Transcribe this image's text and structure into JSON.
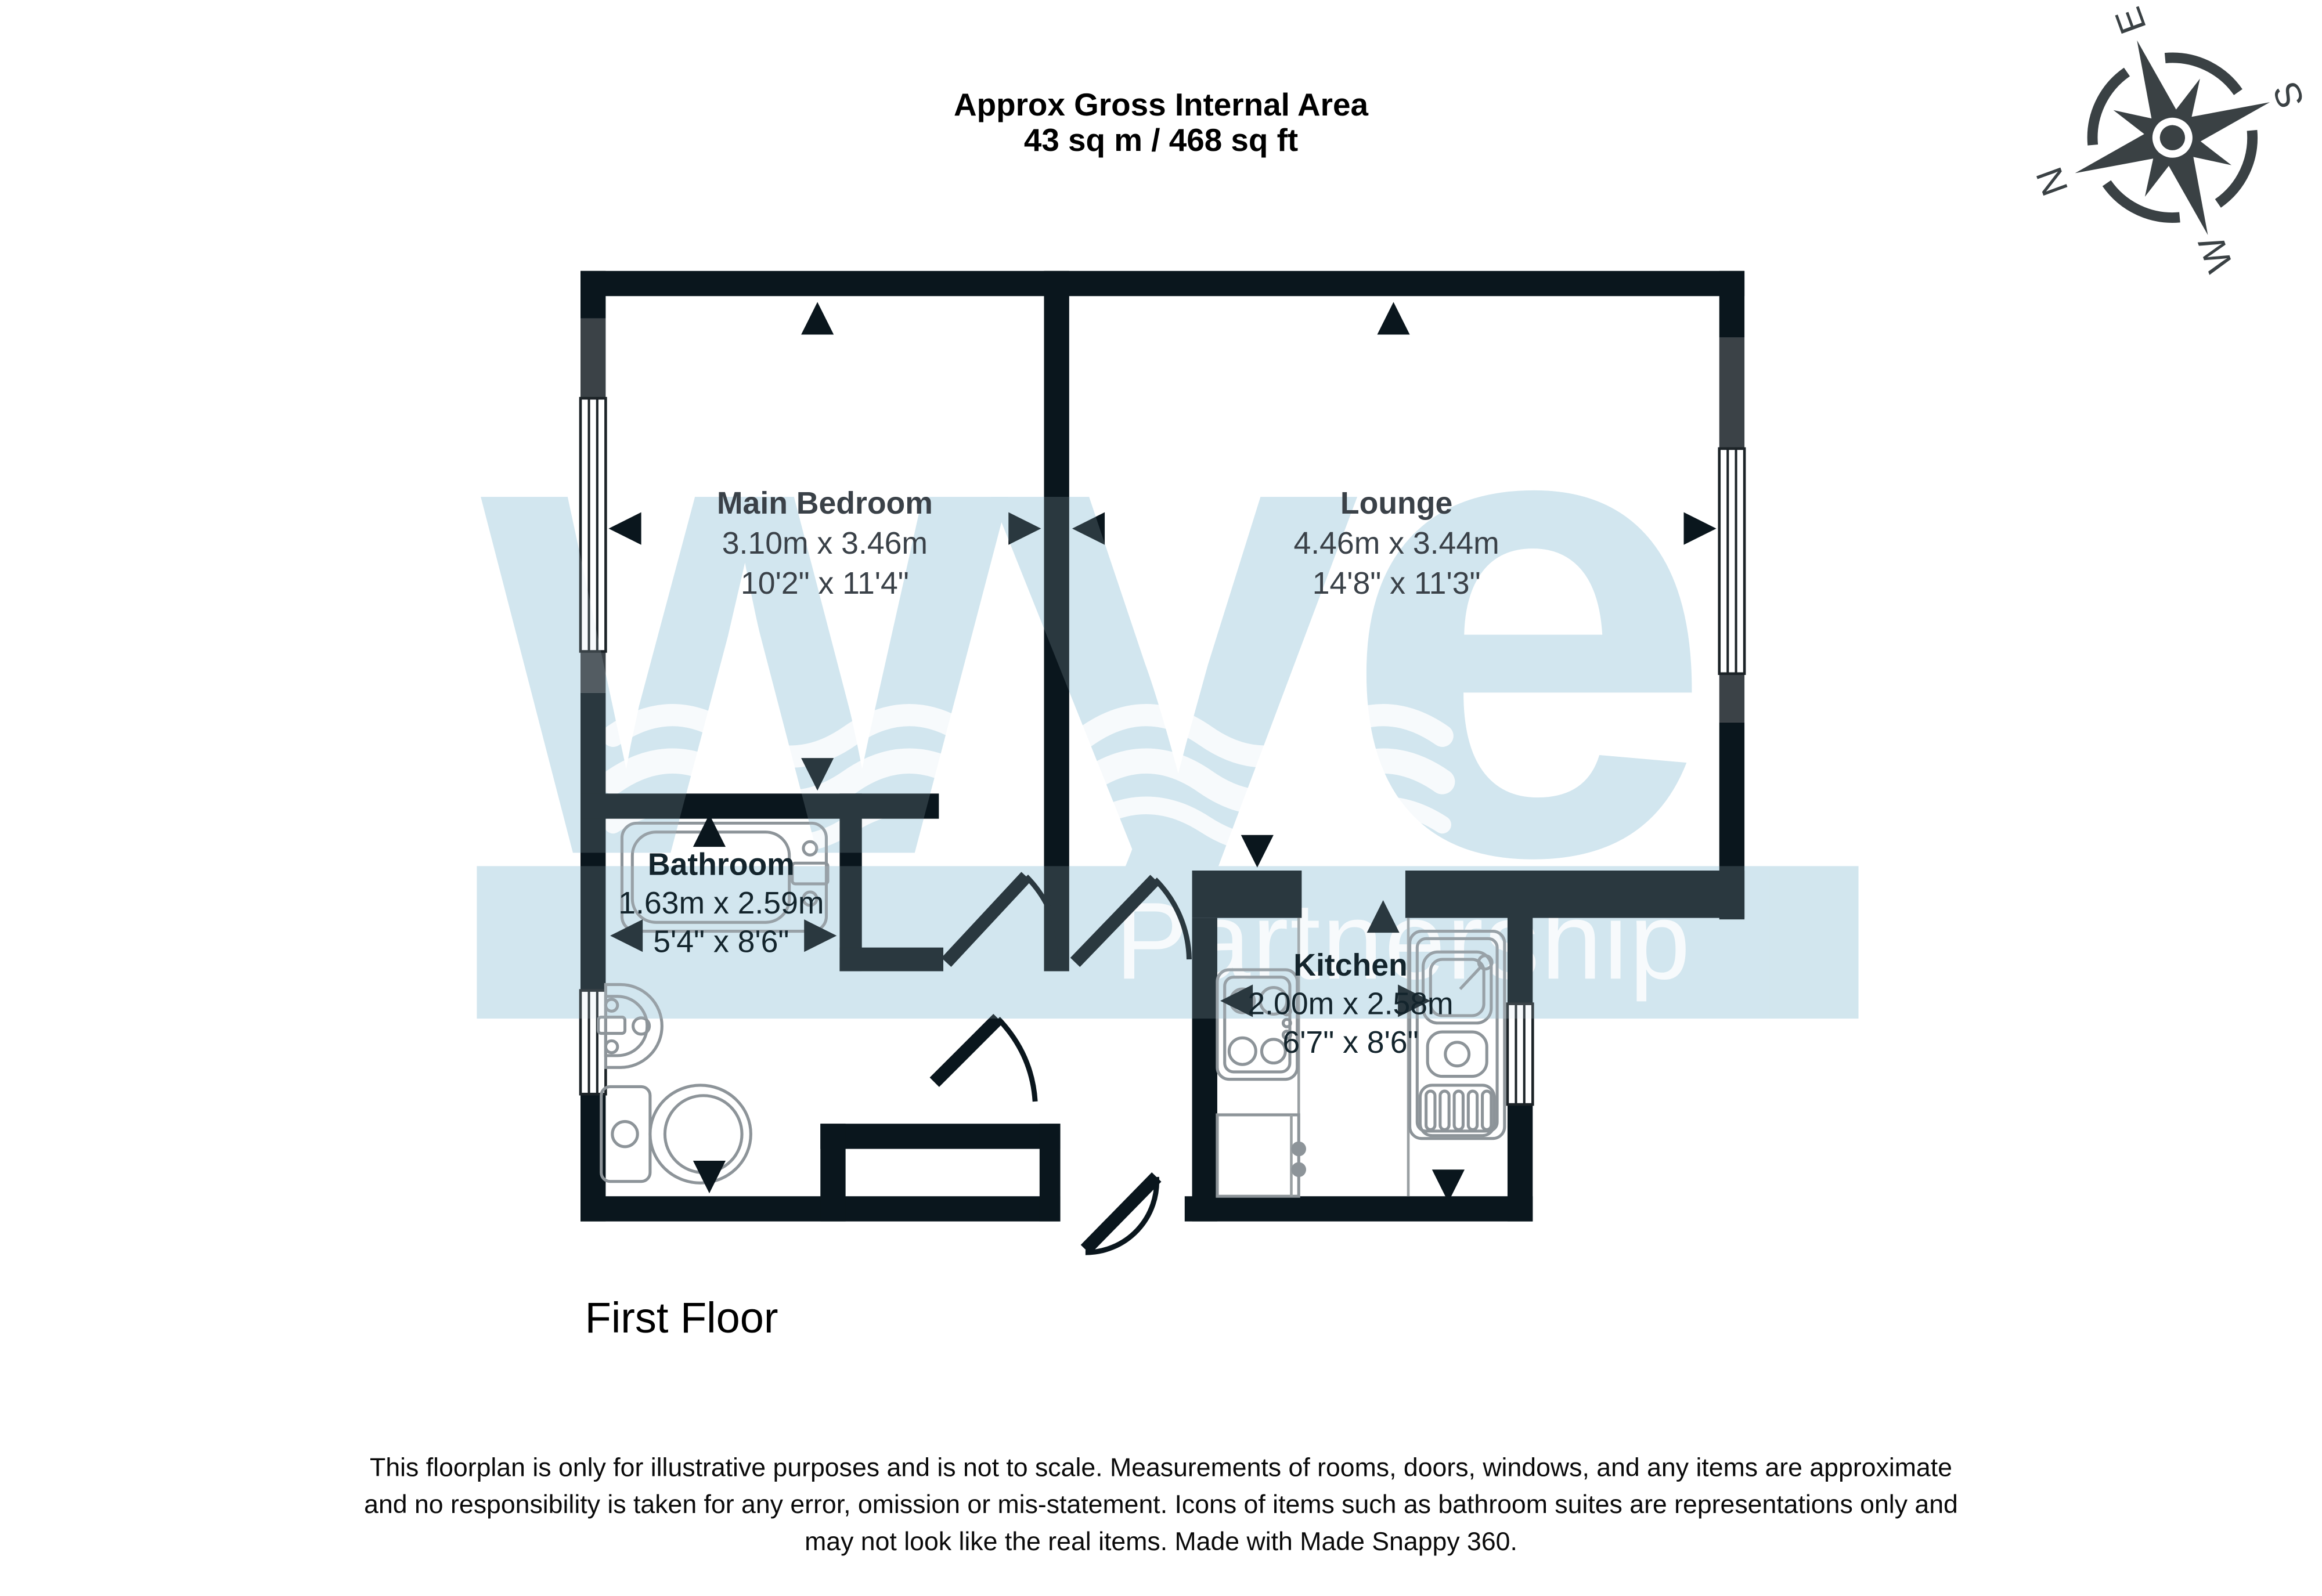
{
  "title": {
    "line1": "Approx Gross Internal Area",
    "line2": "43 sq m / 468 sq ft"
  },
  "floor_label": "First Floor",
  "watermark": {
    "logo": "wye",
    "subtext": "Partnership"
  },
  "compass": {
    "n": "N",
    "e": "E",
    "s": "S",
    "w": "W"
  },
  "rooms": [
    {
      "name": "Main Bedroom",
      "metric": "3.10m x 3.46m",
      "imperial": "10'2\" x 11'4\""
    },
    {
      "name": "Lounge",
      "metric": "4.46m x 3.44m",
      "imperial": "14'8\" x 11'3\""
    },
    {
      "name": "Bathroom",
      "metric": "1.63m x 2.59m",
      "imperial": "5'4\" x 8'6\""
    },
    {
      "name": "Kitchen",
      "metric": "2.00m x 2.58m",
      "imperial": "6'7\" x 8'6\""
    }
  ],
  "disclaimer": {
    "line1": "This floorplan is only for illustrative purposes and is not to scale. Measurements of rooms, doors, windows, and any items are approximate",
    "line2": "and no responsibility is taken for any error, omission or mis-statement. Icons of items such as bathroom suites are representations only and",
    "line3": "may not look like the real items. Made with Made Snappy 360."
  },
  "colors": {
    "wall": "#0a161d",
    "watermark_blue": "#d2e6ef",
    "room_text_dark": "#13242c",
    "room_text_light": "#3a4148"
  }
}
